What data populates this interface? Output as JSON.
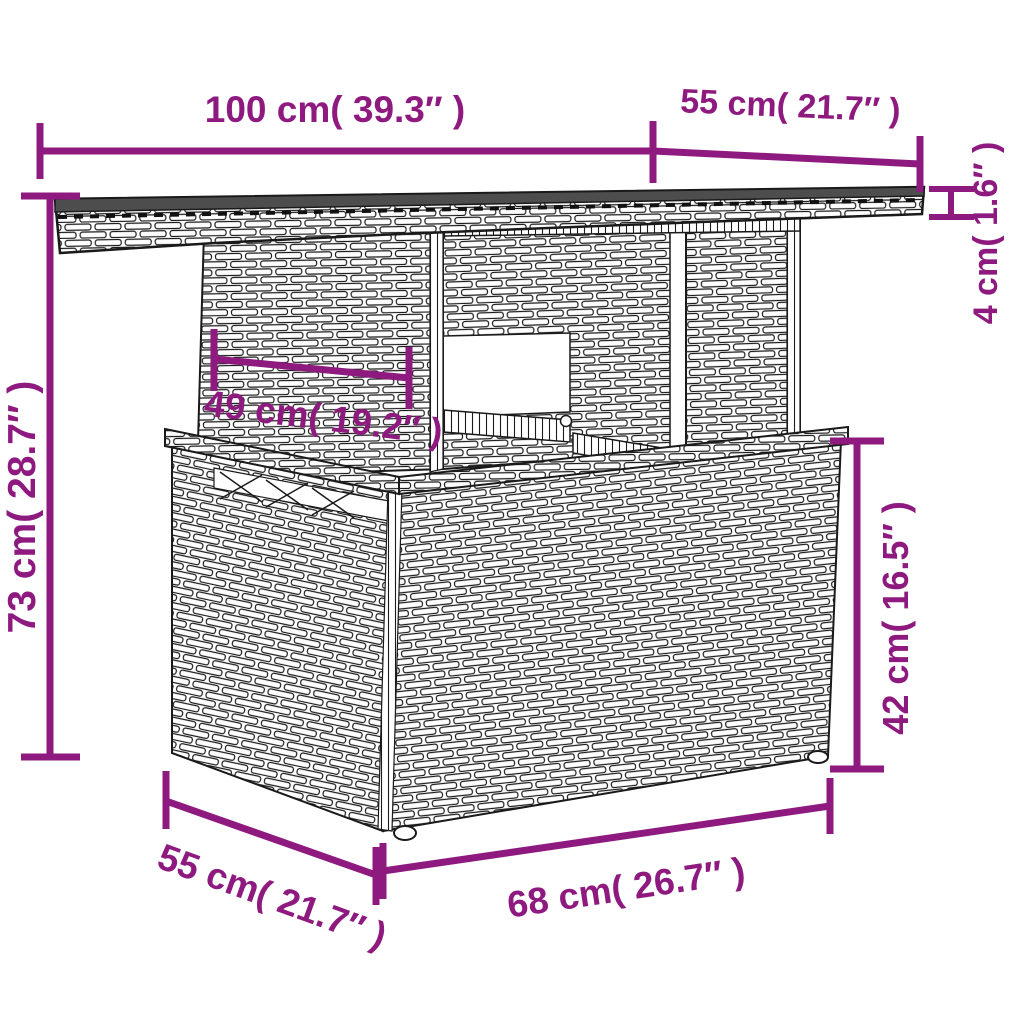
{
  "diagram": {
    "kind": "product-dimension-diagram",
    "subject": "poly-rattan garden table line drawing"
  },
  "colors": {
    "accent_purple": "#8e1a80",
    "line_art": "#1a1a1a",
    "tabletop_surface": "#4d4d4d",
    "background": "#ffffff"
  },
  "dimensions": {
    "tabletop_width": {
      "label": "100 cm( 39.3″ )",
      "cm": "100",
      "inches": "39.3"
    },
    "tabletop_depth": {
      "label": "55 cm( 21.7″ )",
      "cm": "55",
      "inches": "21.7"
    },
    "tabletop_thickness": {
      "label": "4 cm( 1.6″ )",
      "cm": "4",
      "inches": "1.6"
    },
    "total_height": {
      "label": "73 cm( 28.7″ )",
      "cm": "73",
      "inches": "28.7"
    },
    "pedestal_width": {
      "label": "49 cm( 19.2″ )",
      "cm": "49",
      "inches": "19.2"
    },
    "base_height": {
      "label": "42 cm( 16.5″ )",
      "cm": "42",
      "inches": "16.5"
    },
    "base_depth": {
      "label": "55 cm( 21.7″ )",
      "cm": "55",
      "inches": "21.7"
    },
    "base_width": {
      "label": "68 cm( 26.7″ )",
      "cm": "68",
      "inches": "26.7"
    }
  }
}
